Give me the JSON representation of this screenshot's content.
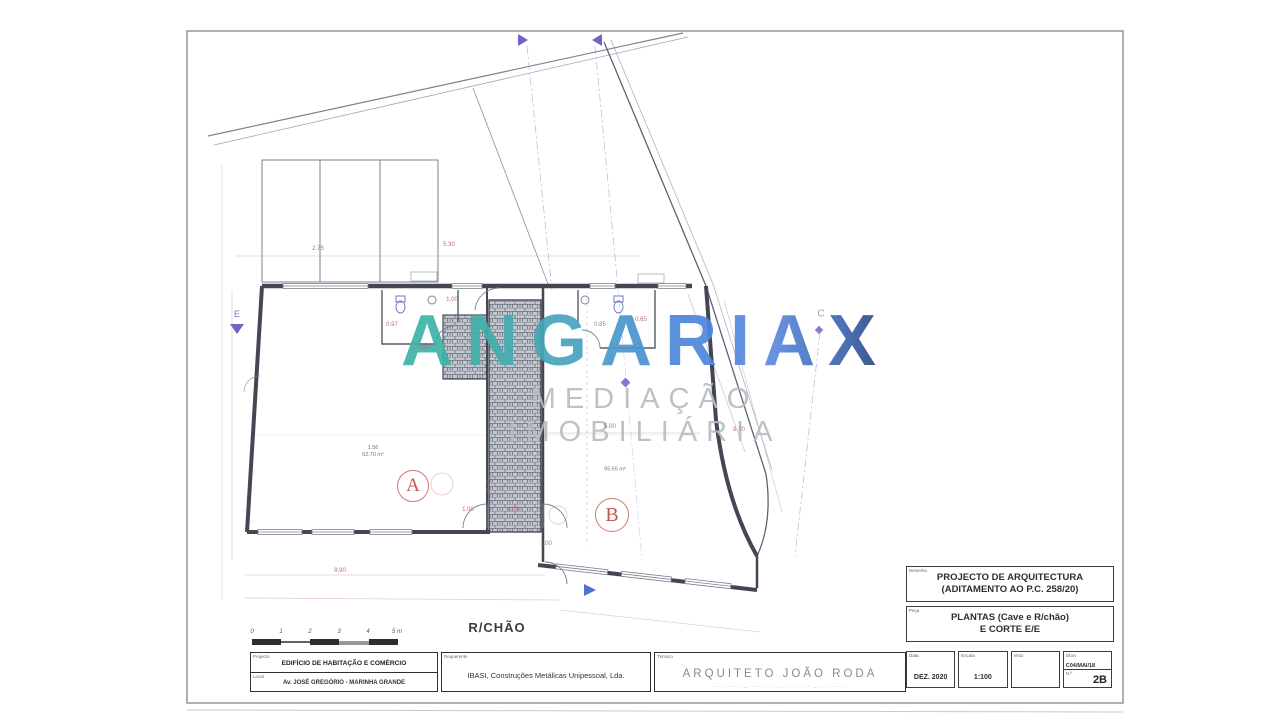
{
  "watermark": {
    "brand": "ANGARIAX",
    "tagline": "MEDIAÇÃO IMOBILIÁRIA",
    "accent_teal": "#3db3a4",
    "accent_blue": "#4b86dc",
    "accent_navy": "#24406f"
  },
  "plan": {
    "floor_label": "R/CHÃO",
    "rooms": [
      {
        "label": "A",
        "area_line1": "1.56",
        "area_line2": "62.70 m²"
      },
      {
        "label": "B",
        "area_line2": "95.65 m²"
      }
    ],
    "markers": {
      "section_left": "E",
      "grid_top_right": "C"
    },
    "dimensions": [
      {
        "x": 452,
        "y": 300,
        "t": "1.00"
      },
      {
        "x": 392,
        "y": 325,
        "t": "0.97"
      },
      {
        "x": 424,
        "y": 348,
        "t": "0.87"
      },
      {
        "x": 600,
        "y": 325,
        "t": "0.85"
      },
      {
        "x": 641,
        "y": 320,
        "t": "0.65"
      },
      {
        "x": 468,
        "y": 510,
        "t": "1.00"
      },
      {
        "x": 513,
        "y": 510,
        "t": "1.00"
      },
      {
        "x": 546,
        "y": 544,
        "t": "1.00"
      },
      {
        "x": 610,
        "y": 427,
        "t": "5.00"
      },
      {
        "x": 739,
        "y": 430,
        "t": "8.70"
      },
      {
        "x": 340,
        "y": 571,
        "t": "8.90"
      },
      {
        "x": 318,
        "y": 249,
        "t": "2.75"
      },
      {
        "x": 449,
        "y": 245,
        "t": "5.30"
      }
    ],
    "scale_bar": {
      "labels": [
        "0",
        "1",
        "2",
        "3",
        "4",
        "5 m"
      ]
    }
  },
  "title_block": {
    "drawing": {
      "label": "Desenho",
      "line1": "PROJECTO DE ARQUITECTURA",
      "line2": "(ADITAMENTO AO P.C. 258/20)"
    },
    "piece": {
      "label": "Peça",
      "line1": "PLANTAS (Cave e R/chão)",
      "line2": "E CORTE E/E"
    },
    "meta": {
      "date_label": "Data",
      "date": "DEZ. 2020",
      "scale_label": "Escala",
      "scale": "1:100",
      "visto_label": "Visto",
      "visto": "",
      "obra_label": "Obra",
      "obra": "C04/MAI/18",
      "num_label": "N.º",
      "num": "2B"
    }
  },
  "info_bar": {
    "project": {
      "label": "Projecto",
      "value": "EDIFÍCIO DE HABITAÇÃO E COMÉRCIO"
    },
    "local": {
      "label": "Local",
      "value": "Av. JOSÉ GREGÓRIO - MARINHA GRANDE"
    },
    "client": {
      "label": "Requerente",
      "value": "IBASI, Construções Metálicas Unipessoal, Lda."
    },
    "technician": {
      "label": "Técnico",
      "value": "ARQUITETO JOÃO RODA",
      "detail": "· ····· ······ ·· — ······ ··· ··· — ···· ··· ··· ··· — · ·· ··· ··· ···"
    }
  }
}
